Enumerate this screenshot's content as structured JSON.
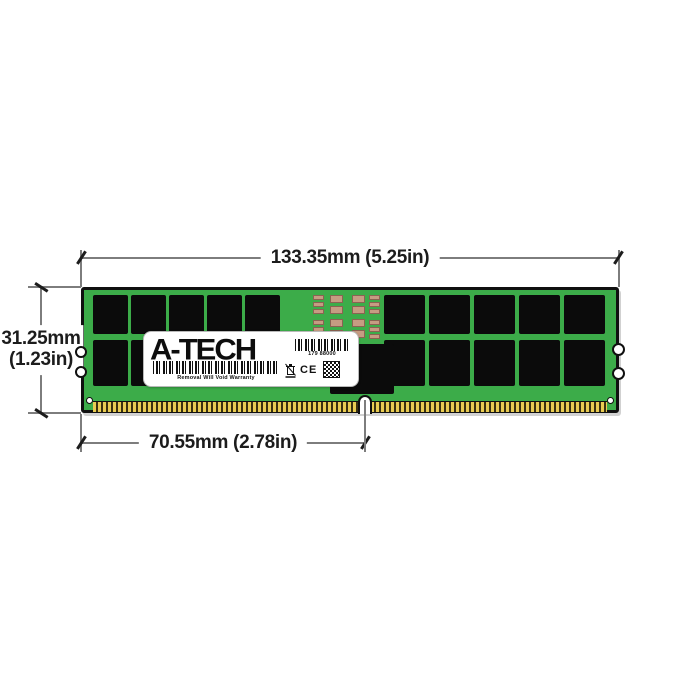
{
  "page": {
    "description": "A-Tech registered server memory module (RDIMM) dimension diagram",
    "background": "#ffffff"
  },
  "annotations": {
    "width_label": "133.35mm (5.25in)",
    "height_label_line1": "31.25mm",
    "height_label_line2": "(1.23in)",
    "pin_span_label": "70.55mm (2.78in)"
  },
  "sticker": {
    "brand": "A-TECH",
    "part_number": "179 88000",
    "warranty_text": "Removal Will Void Warranty",
    "ce_mark": "CE",
    "icons": [
      "serial-barcode",
      "warranty-barcode",
      "weee-bin",
      "qr-code"
    ]
  },
  "colors": {
    "background": "#ffffff",
    "pcb_green": "#3cac49",
    "chip_black": "#0b0b0b",
    "pin_gold": "#e9cc52",
    "smd_tan": "#c69c82",
    "smd_brown": "#8a6352",
    "dim_line": "#7d7d7d",
    "dim_text": "#1c1c1c"
  },
  "module": {
    "left_chip_columns": [
      93,
      131,
      169,
      207,
      245
    ],
    "left_chip_width": 35,
    "right_chip_columns": [
      384,
      429,
      474,
      519,
      564
    ],
    "right_chip_width": 41,
    "top_row": {
      "y": 295,
      "h": 39
    },
    "bottom_row": {
      "y": 340,
      "h": 46
    },
    "smd_columns": [
      {
        "x": 313,
        "w": 11,
        "h": 5,
        "ys": [
          295,
          302,
          309,
          320,
          327,
          334
        ]
      },
      {
        "x": 330,
        "w": 13,
        "h": 8,
        "ys": [
          295,
          306,
          319,
          330
        ]
      },
      {
        "x": 352,
        "w": 13,
        "h": 8,
        "ys": [
          295,
          306,
          319,
          330
        ]
      },
      {
        "x": 369,
        "w": 11,
        "h": 5,
        "ys": [
          295,
          302,
          309,
          320,
          327,
          334
        ]
      }
    ]
  }
}
